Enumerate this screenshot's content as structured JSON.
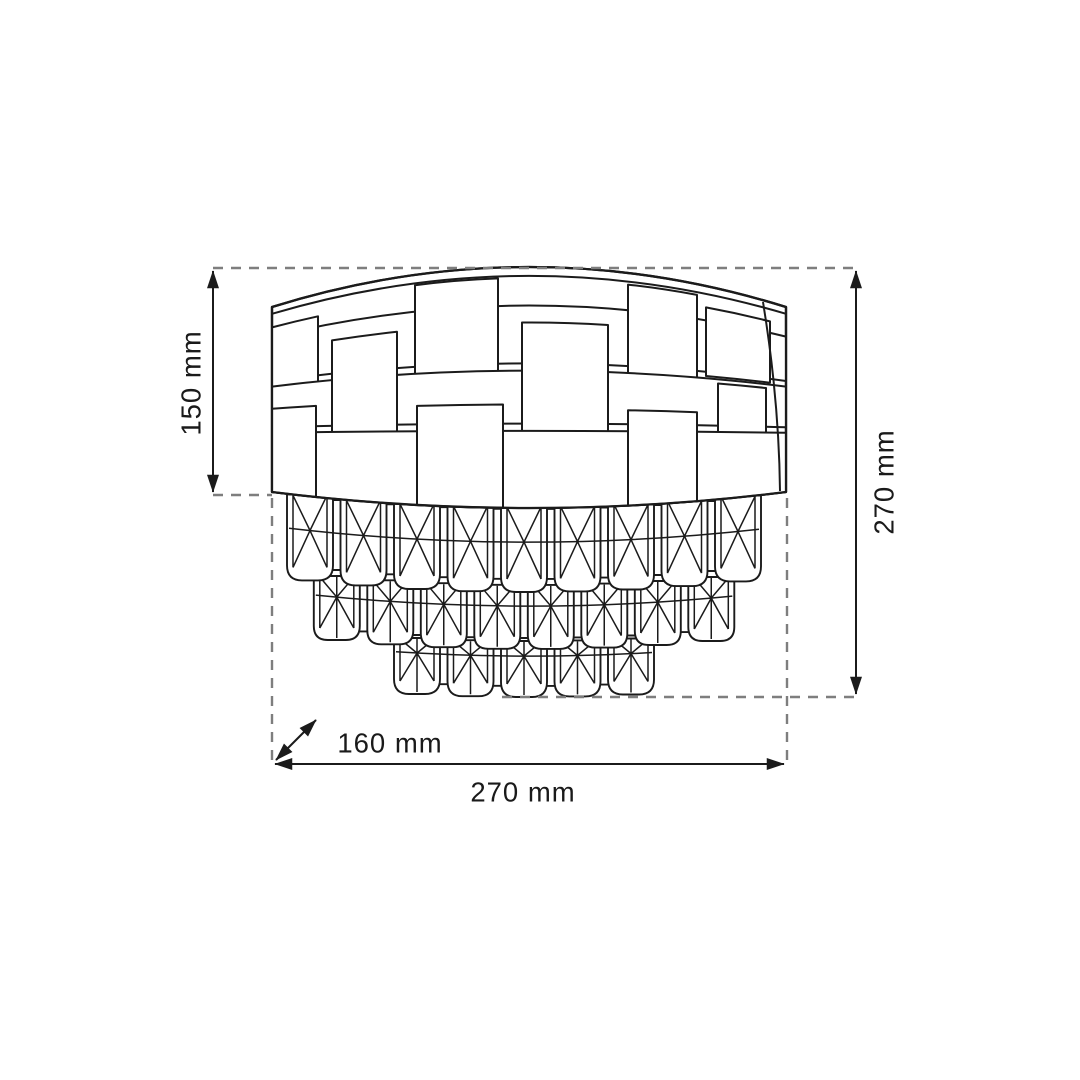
{
  "dimensions": {
    "shade_height": "150 mm",
    "total_height": "270 mm",
    "depth": "160 mm",
    "width": "270 mm"
  }
}
